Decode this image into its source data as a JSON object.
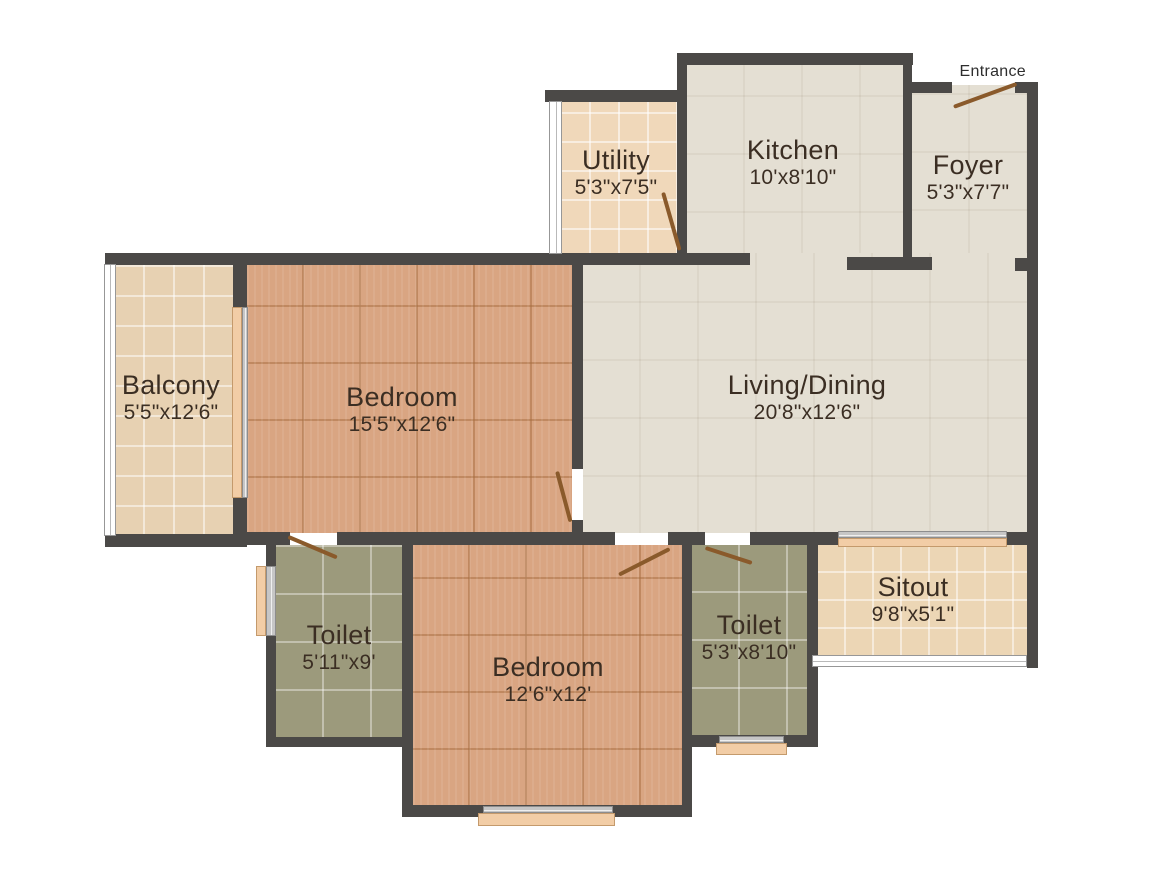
{
  "plan": {
    "entrance_label": "Entrance",
    "rooms": {
      "utility": {
        "name": "Utility",
        "dims": "5'3\"x7'5\""
      },
      "kitchen": {
        "name": "Kitchen",
        "dims": "10'x8'10\""
      },
      "foyer": {
        "name": "Foyer",
        "dims": "5'3\"x7'7\""
      },
      "balcony": {
        "name": "Balcony",
        "dims": "5'5\"x12'6\""
      },
      "bedroom1": {
        "name": "Bedroom",
        "dims": "15'5\"x12'6\""
      },
      "living": {
        "name": "Living/Dining",
        "dims": "20'8\"x12'6\""
      },
      "toilet1": {
        "name": "Toilet",
        "dims": "5'11\"x9'"
      },
      "bedroom2": {
        "name": "Bedroom",
        "dims": "12'6\"x12'"
      },
      "toilet2": {
        "name": "Toilet",
        "dims": "5'3\"x8'10\""
      },
      "sitout": {
        "name": "Sitout",
        "dims": "9'8\"x5'1\""
      }
    },
    "colors": {
      "wall": "#4b4947",
      "hard_floor": "#e4dfd3",
      "wood_floor": "#d9a582",
      "toilet_floor": "#9c9a7c",
      "balcony_floor": "#e7d1b2",
      "utility_floor": "#f0d8ba",
      "sitout_floor": "#ecd6b5",
      "door_swing": "#8a5a2b",
      "window_sill": "#f2cda6",
      "label_text": "#3b2e23"
    }
  }
}
